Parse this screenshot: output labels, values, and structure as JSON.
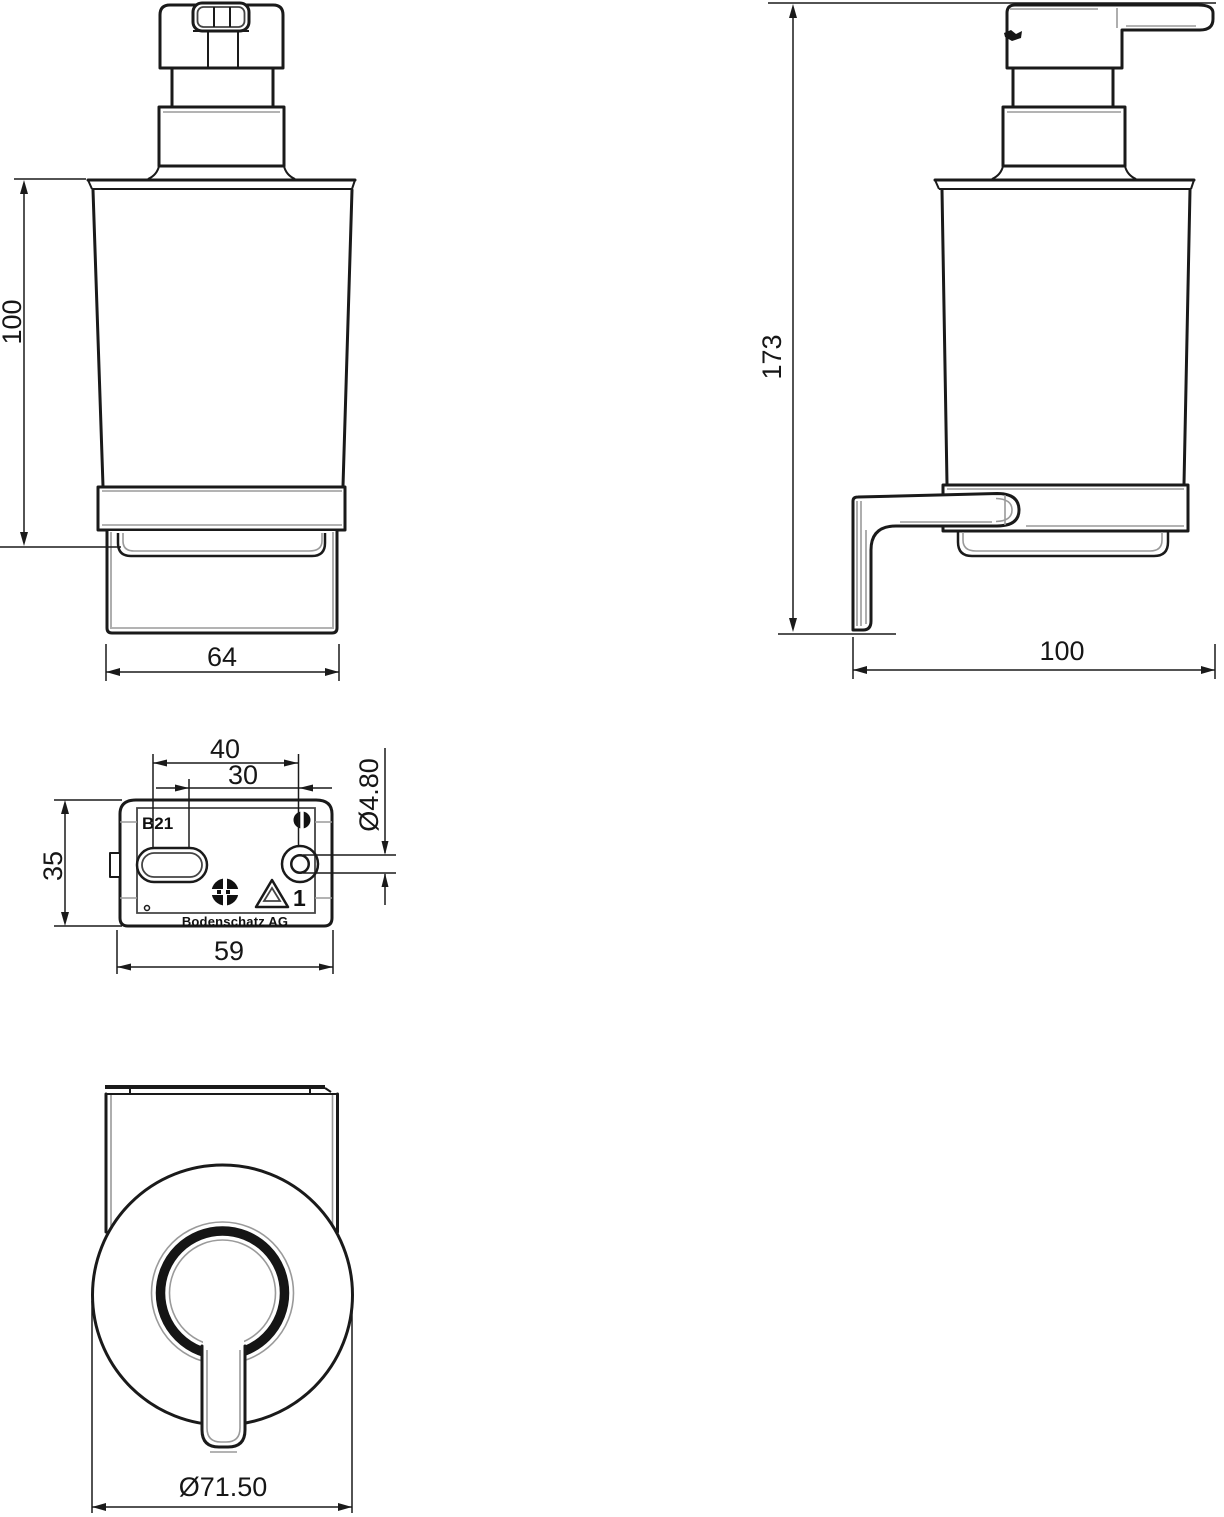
{
  "drawing": {
    "front_view": {
      "height_dim": "100",
      "width_dim": "64"
    },
    "side_view": {
      "height_dim": "173",
      "depth_dim": "100"
    },
    "plate_view": {
      "slot_span_dim": "40",
      "hole_span_dim": "30",
      "hole_dia_dim": "Ø4.80",
      "height_dim": "35",
      "width_dim": "59",
      "model_label": "B21",
      "recycle_code": "1",
      "brand_label": "Bodenschatz AG",
      "icons": {
        "screw_head": "slotted-screw-icon",
        "food_safe": "glass-fork-icon",
        "recycling": "recycling-triangle-icon"
      }
    },
    "bottom_view": {
      "diameter_dim": "Ø71.50"
    },
    "colors": {
      "line": "#1a1a1a",
      "thin_line": "#9a9a9a",
      "background": "#ffffff"
    }
  }
}
